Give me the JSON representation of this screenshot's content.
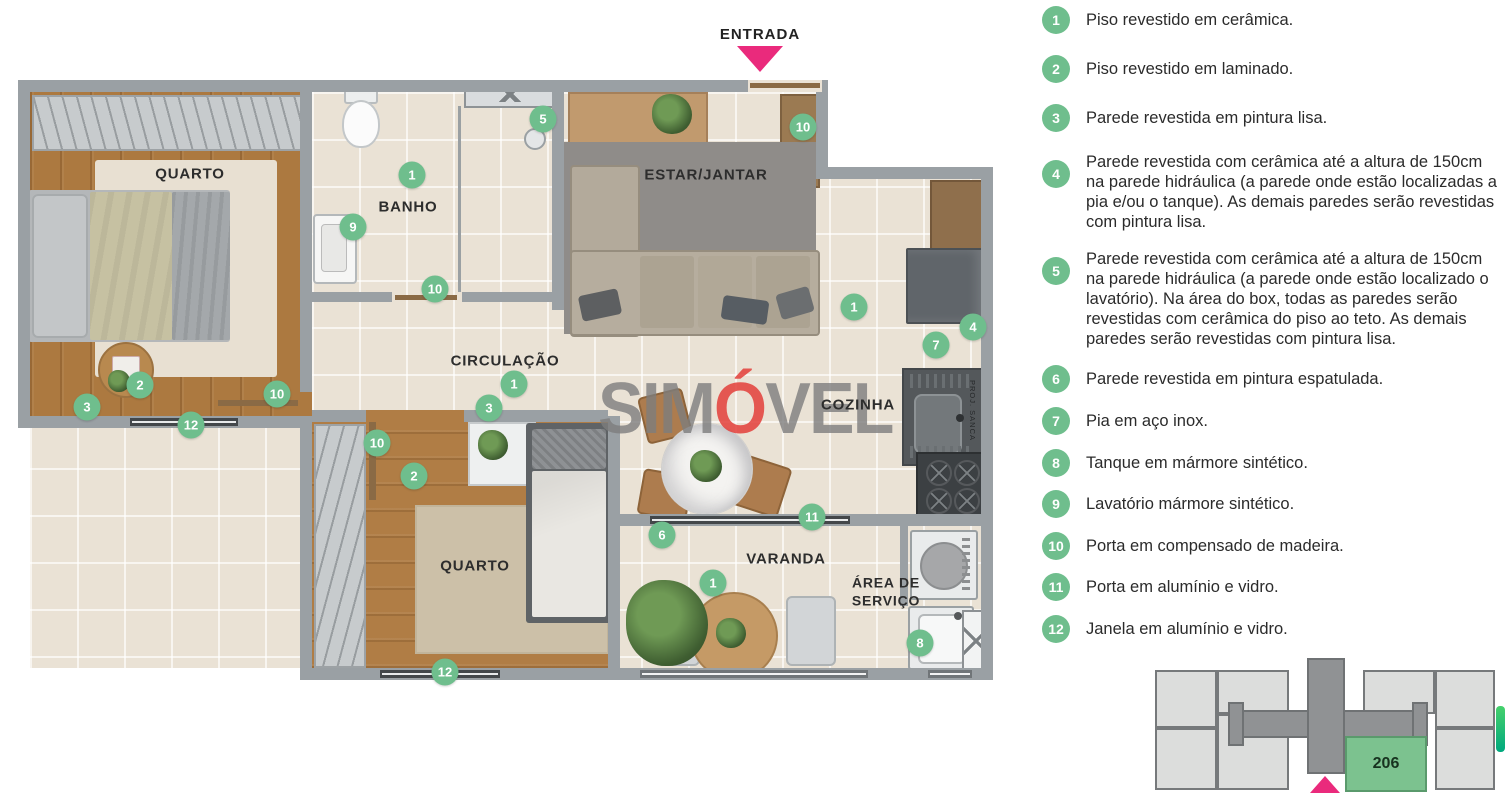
{
  "colors": {
    "badge_green": "#6fbe8d",
    "pink": "#ea2a7c",
    "wall_gray": "#9aa0a4",
    "tile_floor": "#eae2d5",
    "wood_floor": "#ac7940",
    "watermark_gray": "#7d7d7d",
    "watermark_red": "#e33e3a",
    "keyplan_unit_green": "#7cc28f"
  },
  "entrance": {
    "label": "ENTRADA"
  },
  "watermark": {
    "pre": "SIM",
    "accent": "Ó",
    "post": "VEL"
  },
  "floorplan": {
    "rooms": [
      {
        "id": "quarto-1",
        "label": "QUARTO",
        "x": 190,
        "y": 175
      },
      {
        "id": "banho",
        "label": "BANHO",
        "x": 408,
        "y": 208
      },
      {
        "id": "estar-jantar",
        "label": "ESTAR/JANTAR",
        "x": 706,
        "y": 176
      },
      {
        "id": "circulacao",
        "label": "CIRCULAÇÃO",
        "x": 505,
        "y": 362
      },
      {
        "id": "cozinha",
        "label": "COZINHA",
        "x": 858,
        "y": 406
      },
      {
        "id": "quarto-2",
        "label": "QUARTO",
        "x": 475,
        "y": 567
      },
      {
        "id": "varanda",
        "label": "VARANDA",
        "x": 786,
        "y": 560
      },
      {
        "id": "area-servico",
        "label": "ÁREA DE\nSERVIÇO",
        "x": 886,
        "y": 592
      }
    ],
    "annotations": [
      {
        "id": "proj-sanca",
        "label": "PROJ. SANCA"
      }
    ],
    "badges": [
      {
        "n": "5",
        "x": 543,
        "y": 119
      },
      {
        "n": "10",
        "x": 803,
        "y": 127
      },
      {
        "n": "1",
        "x": 412,
        "y": 175
      },
      {
        "n": "9",
        "x": 353,
        "y": 227
      },
      {
        "n": "10",
        "x": 435,
        "y": 289
      },
      {
        "n": "1",
        "x": 854,
        "y": 307
      },
      {
        "n": "4",
        "x": 973,
        "y": 327
      },
      {
        "n": "7",
        "x": 936,
        "y": 345
      },
      {
        "n": "1",
        "x": 514,
        "y": 384
      },
      {
        "n": "3",
        "x": 489,
        "y": 408
      },
      {
        "n": "2",
        "x": 140,
        "y": 385
      },
      {
        "n": "3",
        "x": 87,
        "y": 407
      },
      {
        "n": "10",
        "x": 277,
        "y": 394
      },
      {
        "n": "12",
        "x": 191,
        "y": 425
      },
      {
        "n": "10",
        "x": 377,
        "y": 443
      },
      {
        "n": "2",
        "x": 414,
        "y": 476
      },
      {
        "n": "11",
        "x": 812,
        "y": 517
      },
      {
        "n": "6",
        "x": 662,
        "y": 535
      },
      {
        "n": "1",
        "x": 713,
        "y": 583
      },
      {
        "n": "8",
        "x": 920,
        "y": 643
      },
      {
        "n": "12",
        "x": 445,
        "y": 672
      }
    ]
  },
  "legend": {
    "items": [
      {
        "n": "1",
        "text": "Piso revestido em cerâmica."
      },
      {
        "n": "2",
        "text": "Piso revestido em laminado."
      },
      {
        "n": "3",
        "text": "Parede revestida em pintura lisa."
      },
      {
        "n": "4",
        "text": "Parede revestida com cerâmica até a altura de 150cm na parede hidráulica (a parede onde estão localizadas a pia e/ou o tanque). As demais paredes serão revestidas com pintura lisa."
      },
      {
        "n": "5",
        "text": "Parede revestida com cerâmica até a altura de 150cm na parede hidráulica (a parede onde estão localizado o lavatório). Na área do box, todas as paredes serão revestidas com cerâmica do piso ao teto. As demais paredes serão revestidas com pintura lisa."
      },
      {
        "n": "6",
        "text": "Parede revestida em pintura espatulada."
      },
      {
        "n": "7",
        "text": "Pia em aço inox."
      },
      {
        "n": "8",
        "text": "Tanque em mármore sintético."
      },
      {
        "n": "9",
        "text": "Lavatório mármore sintético."
      },
      {
        "n": "10",
        "text": "Porta em compensado de madeira."
      },
      {
        "n": "11",
        "text": "Porta em alumínio e vidro."
      },
      {
        "n": "12",
        "text": "Janela em alumínio e vidro."
      }
    ]
  },
  "keyplan": {
    "unit_label": "206"
  }
}
